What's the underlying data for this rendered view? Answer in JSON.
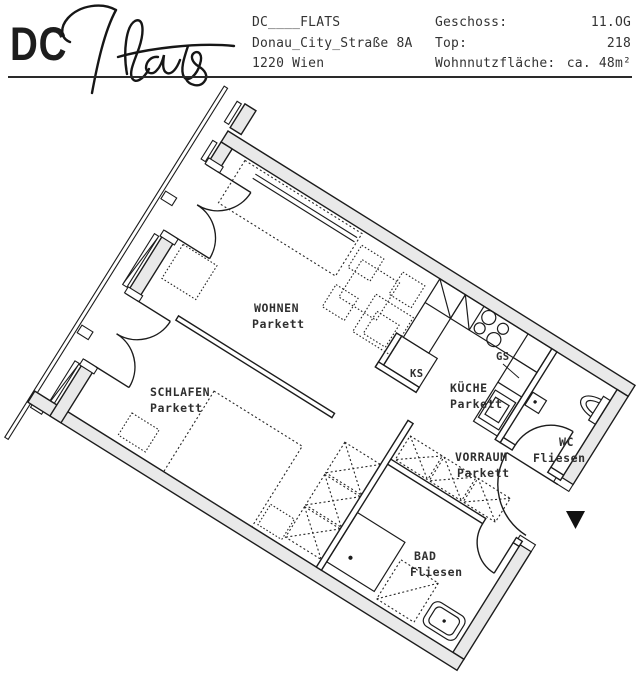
{
  "header": {
    "logo": "DC",
    "signature": "Flats",
    "address": {
      "line1": "DC____FLATS",
      "line2": "Donau_City_Straße 8A",
      "line3": "1220 Wien"
    },
    "details": [
      {
        "label": "Geschoss:",
        "value": "11.OG"
      },
      {
        "label": "Top:",
        "value": "218"
      },
      {
        "label": "Wohnnutzfläche:",
        "value": "ca. 48m²"
      }
    ]
  },
  "floorplan": {
    "rooms": [
      {
        "id": "wohnen",
        "name": "WOHNEN",
        "floor": "Parkett"
      },
      {
        "id": "schlafen",
        "name": "SCHLAFEN",
        "floor": "Parkett"
      },
      {
        "id": "kueche",
        "name": "KÜCHE",
        "floor": "Parkett"
      },
      {
        "id": "vorraum",
        "name": "VORRAUM",
        "floor": "Parkett"
      },
      {
        "id": "wc",
        "name": "WC",
        "floor": "Fliesen"
      },
      {
        "id": "bad",
        "name": "BAD",
        "floor": "Fliesen"
      }
    ],
    "appliances": {
      "fridge": "KS",
      "dishwasher": "GS"
    },
    "entrance_marker": "entrance-arrow",
    "rotation_deg": 32,
    "colors": {
      "wall_fill": "#e9e9e9",
      "line": "#1c1c1c",
      "label_text": "#2f2f2f"
    }
  }
}
